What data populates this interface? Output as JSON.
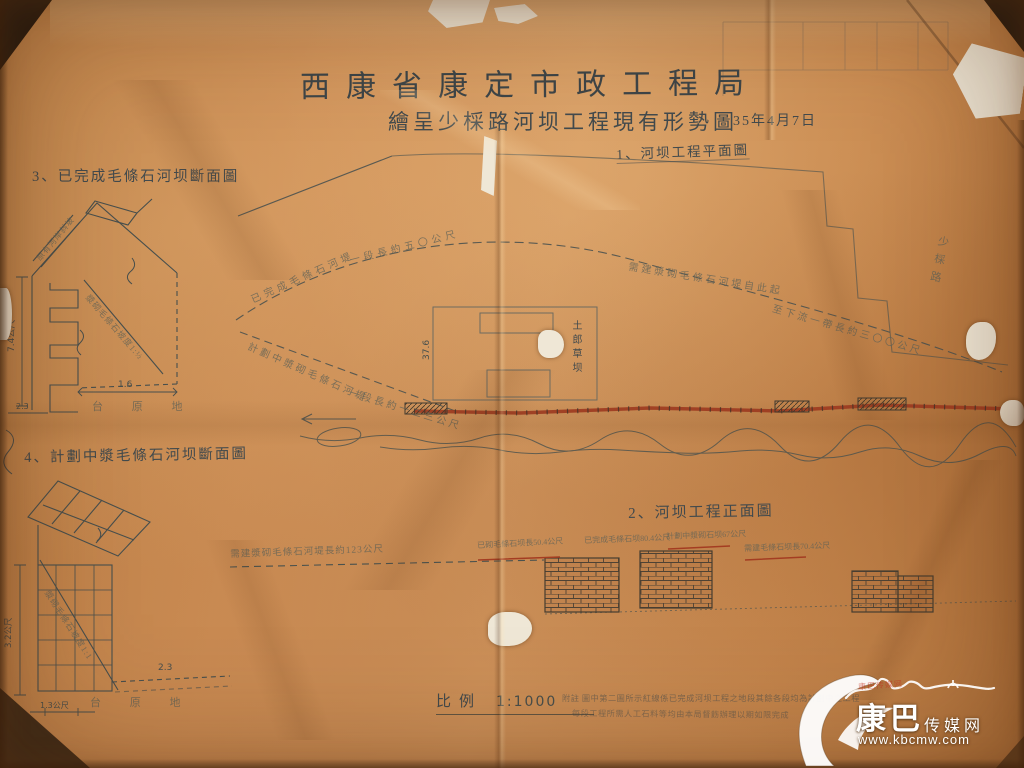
{
  "colors": {
    "paper": "#cf9057",
    "ink": "#424a4d",
    "red_line": "#9e3a20",
    "tear_white": "#efe7d6",
    "watermark_white": "#ffffff"
  },
  "header": {
    "bureau": "西康省康定市政工程局",
    "subtitle": "繪呈少棌路河坝工程現有形勢圖",
    "date": "35年4月7日"
  },
  "figures": {
    "plan": {
      "label": "1、河坝工程平面圖"
    },
    "front": {
      "label": "2、河坝工程正面圖"
    },
    "section_done": {
      "label": "3、已完成毛條石河坝斷面圖"
    },
    "section_planned": {
      "label": "4、計劃中漿毛條石河坝斷面圖"
    }
  },
  "plan": {
    "annotations": [
      {
        "text": "已完成毛條石河堤"
      },
      {
        "text": "一段長約五〇公尺"
      },
      {
        "text": "需建漿砌毛條石河堤自此起"
      },
      {
        "text": "至下流一帶長約三〇〇公尺"
      },
      {
        "text": "計劃中漿砌毛條石河堤"
      },
      {
        "text": "一段長約一二三公尺"
      }
    ],
    "road_label": "少棌路",
    "building_label": "土郎草坝",
    "dimension": "37.6"
  },
  "elevation": {
    "left_label": "需建漿砌毛條石河堤長約123公尺",
    "wall_labels": [
      {
        "text": "已砌毛條石坝長50.4公尺"
      },
      {
        "text": "已完成毛條石坝80.4公尺"
      },
      {
        "text": "計劃中漿砌石坝67公尺"
      },
      {
        "text": "需建毛條石坝長70.4公尺"
      }
    ]
  },
  "section_done": {
    "height_dim": "7.4公尺",
    "base_dim": "1.6",
    "side_dim": "2.3",
    "ground_label": "台 原 地",
    "slope_label": "漿砌毛條石坡度1:½",
    "top_label": "原有河岸斜坡"
  },
  "section_planned": {
    "height_dim": "3.2公尺",
    "base_dim": "2.3",
    "bottom_dim": "1.3公尺",
    "ground_label": "台 原 地",
    "slope_label": "漿砌毛條石坡度1:1"
  },
  "scale": {
    "label": "比例",
    "value": "1:1000"
  },
  "notes": {
    "line1": "附註 圖中第二圖所示紅線係已完成河坝工程之地段其餘各段均為計劃中之工程",
    "line2": "每段工程所需人工石料等均由本局督飭辦理以期如限完成"
  },
  "watermark": {
    "name_main": "康巴",
    "name_sub": "传媒网",
    "url": "www.kbcmw.com",
    "red_mark": "康巴传媒网"
  }
}
